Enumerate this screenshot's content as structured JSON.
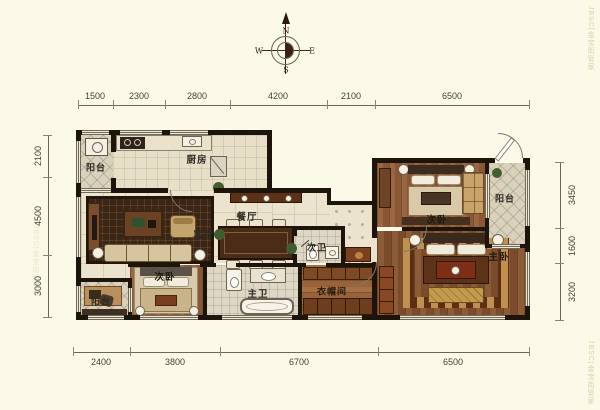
{
  "title": "apartment-floor-plan",
  "compass": {
    "north": "N",
    "south": "S",
    "east": "E",
    "west": "W"
  },
  "dimensions": {
    "top": [
      "1500",
      "2300",
      "2800",
      "4200",
      "2100",
      "6500"
    ],
    "bottom": [
      "2400",
      "3800",
      "6700",
      "6500"
    ],
    "left": [
      "2100",
      "4500",
      "3000"
    ],
    "right": [
      "3450",
      "1600",
      "3200"
    ]
  },
  "rooms": {
    "balcony_tl": "阳台",
    "kitchen": "厨房",
    "dining": "餐厅",
    "living": "客厅",
    "bath2": "次卫",
    "bedroom2_right": "次卧",
    "balcony_right": "阳台",
    "master_bedroom": "主卧",
    "master_bath": "主卫",
    "closet": "衣帽间",
    "bedroom2_left": "次卧",
    "balcony_bl": "阳台"
  },
  "watermark": {
    "text": "JBSC|金宝街管家"
  },
  "colors": {
    "background": "#fbf9e7",
    "wall": "#1d140c",
    "tile_floor": "#ebe3cd",
    "wood_floor": "#8a5634",
    "rug_dark": "#3a2517",
    "accent_gold": "#c49a4e"
  }
}
